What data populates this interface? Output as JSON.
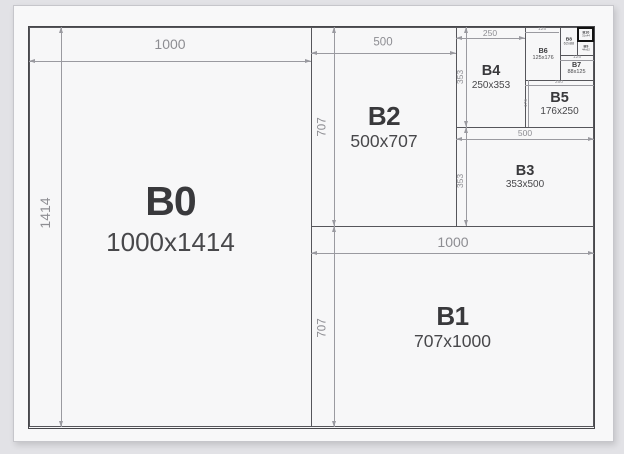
{
  "colors": {
    "background": "#e2e2e6",
    "sheet": "#f8f8f9",
    "box_border": "#56565b",
    "highlight_border": "#121212",
    "dim_line": "#9a9aa0",
    "dim_text": "#8d8d92",
    "label_text": "#39393c",
    "size_text": "#48484b"
  },
  "papers": [
    {
      "name": "b0",
      "label": "B0",
      "dims": "1000x1414",
      "tier": "t0",
      "highlight": false,
      "rect": {
        "x": 0,
        "y": 0,
        "w": 283,
        "h": 400
      }
    },
    {
      "name": "b2",
      "label": "B2",
      "dims": "500x707",
      "tier": "t1",
      "highlight": false,
      "rect": {
        "x": 282,
        "y": 0,
        "w": 146,
        "h": 200
      }
    },
    {
      "name": "b1",
      "label": "B1",
      "dims": "707x1000",
      "tier": "t1",
      "highlight": false,
      "rect": {
        "x": 282,
        "y": 199,
        "w": 283,
        "h": 201
      }
    },
    {
      "name": "b4",
      "label": "B4",
      "dims": "250x353",
      "tier": "t2",
      "highlight": false,
      "rect": {
        "x": 427,
        "y": 0,
        "w": 70,
        "h": 101
      }
    },
    {
      "name": "b3",
      "label": "B3",
      "dims": "353x500",
      "tier": "t2",
      "highlight": false,
      "rect": {
        "x": 427,
        "y": 100,
        "w": 138,
        "h": 100
      }
    },
    {
      "name": "b5",
      "label": "B5",
      "dims": "176x250",
      "tier": "t2",
      "highlight": false,
      "rect": {
        "x": 496,
        "y": 53,
        "w": 69,
        "h": 48
      }
    },
    {
      "name": "b6",
      "label": "B6",
      "dims": "125x176",
      "tier": "t3",
      "highlight": false,
      "rect": {
        "x": 496,
        "y": 0,
        "w": 35.5,
        "h": 54
      }
    },
    {
      "name": "b7",
      "label": "B7",
      "dims": "88x125",
      "tier": "t3",
      "highlight": false,
      "rect": {
        "x": 530.5,
        "y": 28,
        "w": 34.5,
        "h": 26
      }
    },
    {
      "name": "b8",
      "label": "B8",
      "dims": "62x88",
      "tier": "t4",
      "highlight": false,
      "rect": {
        "x": 530.5,
        "y": 0,
        "w": 18.5,
        "h": 29
      }
    },
    {
      "name": "b9",
      "label": "B9",
      "dims": "44x62",
      "tier": "t5",
      "highlight": false,
      "rect": {
        "x": 548,
        "y": 14,
        "w": 17,
        "h": 15
      }
    },
    {
      "name": "b10",
      "label": "B10",
      "dims": "31x44",
      "tier": "t5",
      "highlight": true,
      "rect": {
        "x": 548,
        "y": 0,
        "w": 17,
        "h": 15
      }
    }
  ],
  "dimensions": [
    {
      "label": "1000",
      "orient": "h",
      "size": "lg",
      "line": {
        "x": 0,
        "y": 34,
        "len": 282
      },
      "text": {
        "x": 141,
        "y": 17
      }
    },
    {
      "label": "1414",
      "orient": "v",
      "size": "lg",
      "line": {
        "x": 32,
        "y": 0,
        "len": 400
      },
      "text": {
        "x": 16,
        "y": 186
      }
    },
    {
      "label": "500",
      "orient": "h",
      "size": "md",
      "line": {
        "x": 282,
        "y": 26,
        "len": 145
      },
      "text": {
        "x": 354,
        "y": 16
      }
    },
    {
      "label": "707",
      "orient": "v",
      "size": "md",
      "line": {
        "x": 305,
        "y": 0,
        "len": 199
      },
      "text": {
        "x": 294,
        "y": 100
      }
    },
    {
      "label": "1000",
      "orient": "h",
      "size": "lg",
      "line": {
        "x": 282,
        "y": 226,
        "len": 283
      },
      "text": {
        "x": 424,
        "y": 215
      }
    },
    {
      "label": "707",
      "orient": "v",
      "size": "md",
      "line": {
        "x": 305,
        "y": 199,
        "len": 201
      },
      "text": {
        "x": 294,
        "y": 301
      }
    },
    {
      "label": "250",
      "orient": "h",
      "size": "sm",
      "line": {
        "x": 427,
        "y": 11,
        "len": 69
      },
      "text": {
        "x": 461,
        "y": 6
      }
    },
    {
      "label": "353",
      "orient": "v",
      "size": "sm",
      "line": {
        "x": 437,
        "y": 0,
        "len": 100
      },
      "text": {
        "x": 431,
        "y": 50
      }
    },
    {
      "label": "500",
      "orient": "h",
      "size": "sm",
      "line": {
        "x": 427,
        "y": 112,
        "len": 138
      },
      "text": {
        "x": 496,
        "y": 106
      }
    },
    {
      "label": "353",
      "orient": "v",
      "size": "sm",
      "line": {
        "x": 437,
        "y": 100,
        "len": 99
      },
      "text": {
        "x": 431,
        "y": 154
      }
    },
    {
      "label": "125",
      "orient": "h",
      "size": "xs",
      "line": {
        "x": 496,
        "y": 5,
        "len": 34
      },
      "text": {
        "x": 513,
        "y": 2
      }
    },
    {
      "label": "250",
      "orient": "h",
      "size": "xs",
      "line": {
        "x": 496,
        "y": 58,
        "len": 69
      },
      "text": {
        "x": 530,
        "y": 55
      }
    },
    {
      "label": "176",
      "orient": "v",
      "size": "xs",
      "line": {
        "x": 499,
        "y": 53,
        "len": 47
      },
      "text": {
        "x": 496.5,
        "y": 76
      }
    },
    {
      "label": "125",
      "orient": "h",
      "size": "xs",
      "line": {
        "x": 530.5,
        "y": 33,
        "len": 34
      },
      "text": {
        "x": 548,
        "y": 30
      }
    }
  ]
}
